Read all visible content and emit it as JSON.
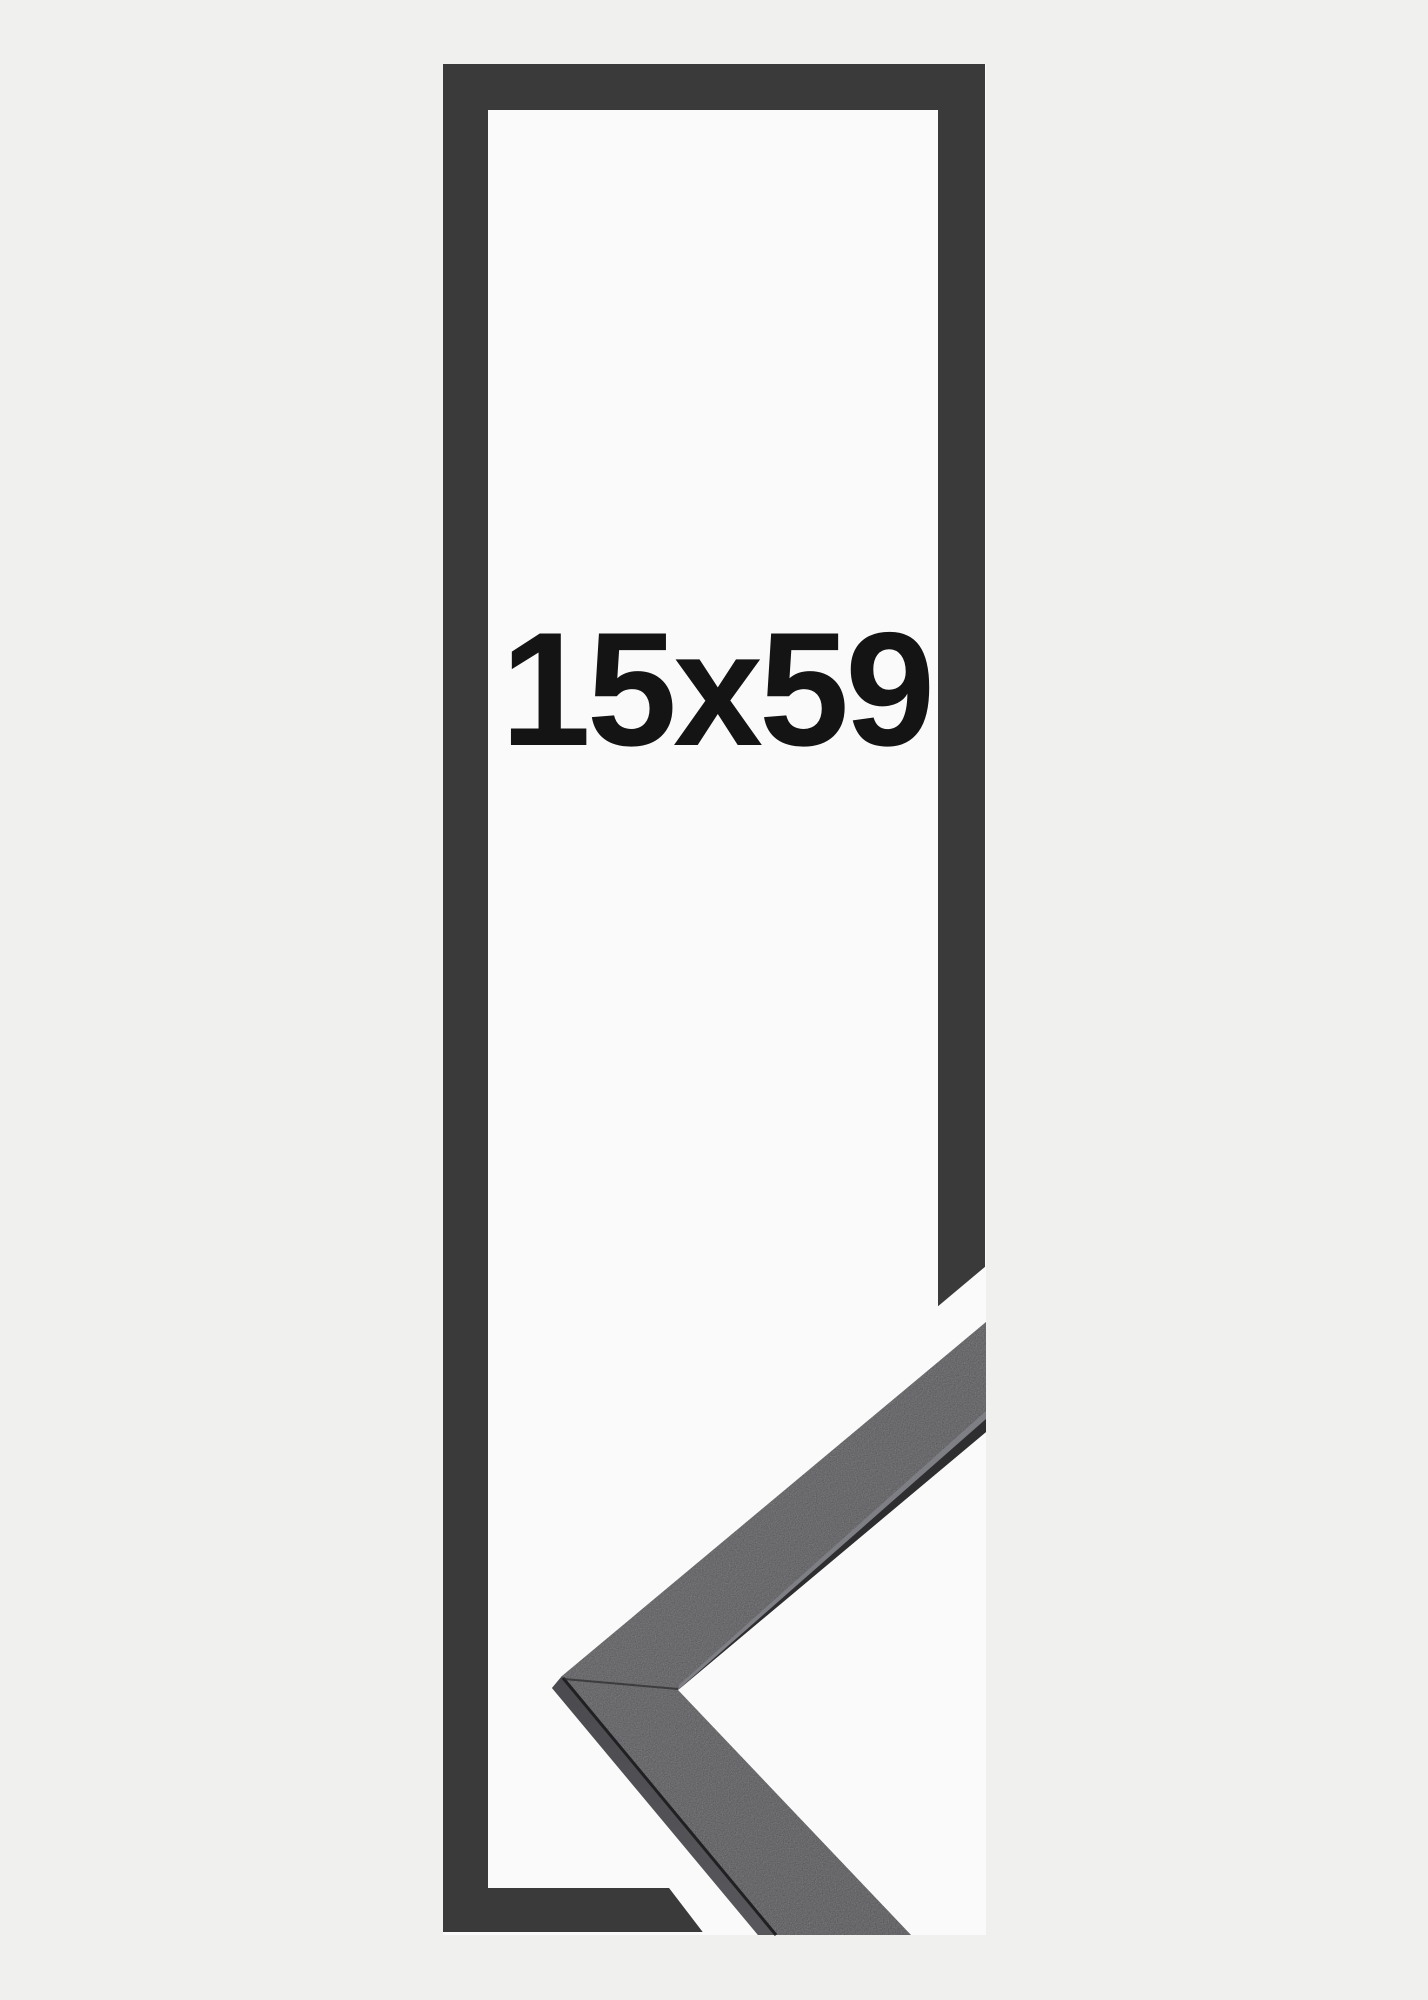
{
  "product": {
    "size_label": "15x59"
  },
  "colors": {
    "page_background": "#f0f0ef",
    "photo_background": "#fafafa",
    "frame_outline": "#3a3a3b",
    "moulding_face": "#39393b",
    "moulding_face_light": "#434345",
    "moulding_side": "#58585c",
    "moulding_side_dark": "#4b4b4f",
    "moulding_inner_highlight": "#7e7f84",
    "moulding_inner_strip": "#2e2e30",
    "moulding_crease": "#202022",
    "moulding_miter_seam": "#2a2a2c",
    "halo_white": "#fafafa",
    "label_text": "#141414"
  }
}
